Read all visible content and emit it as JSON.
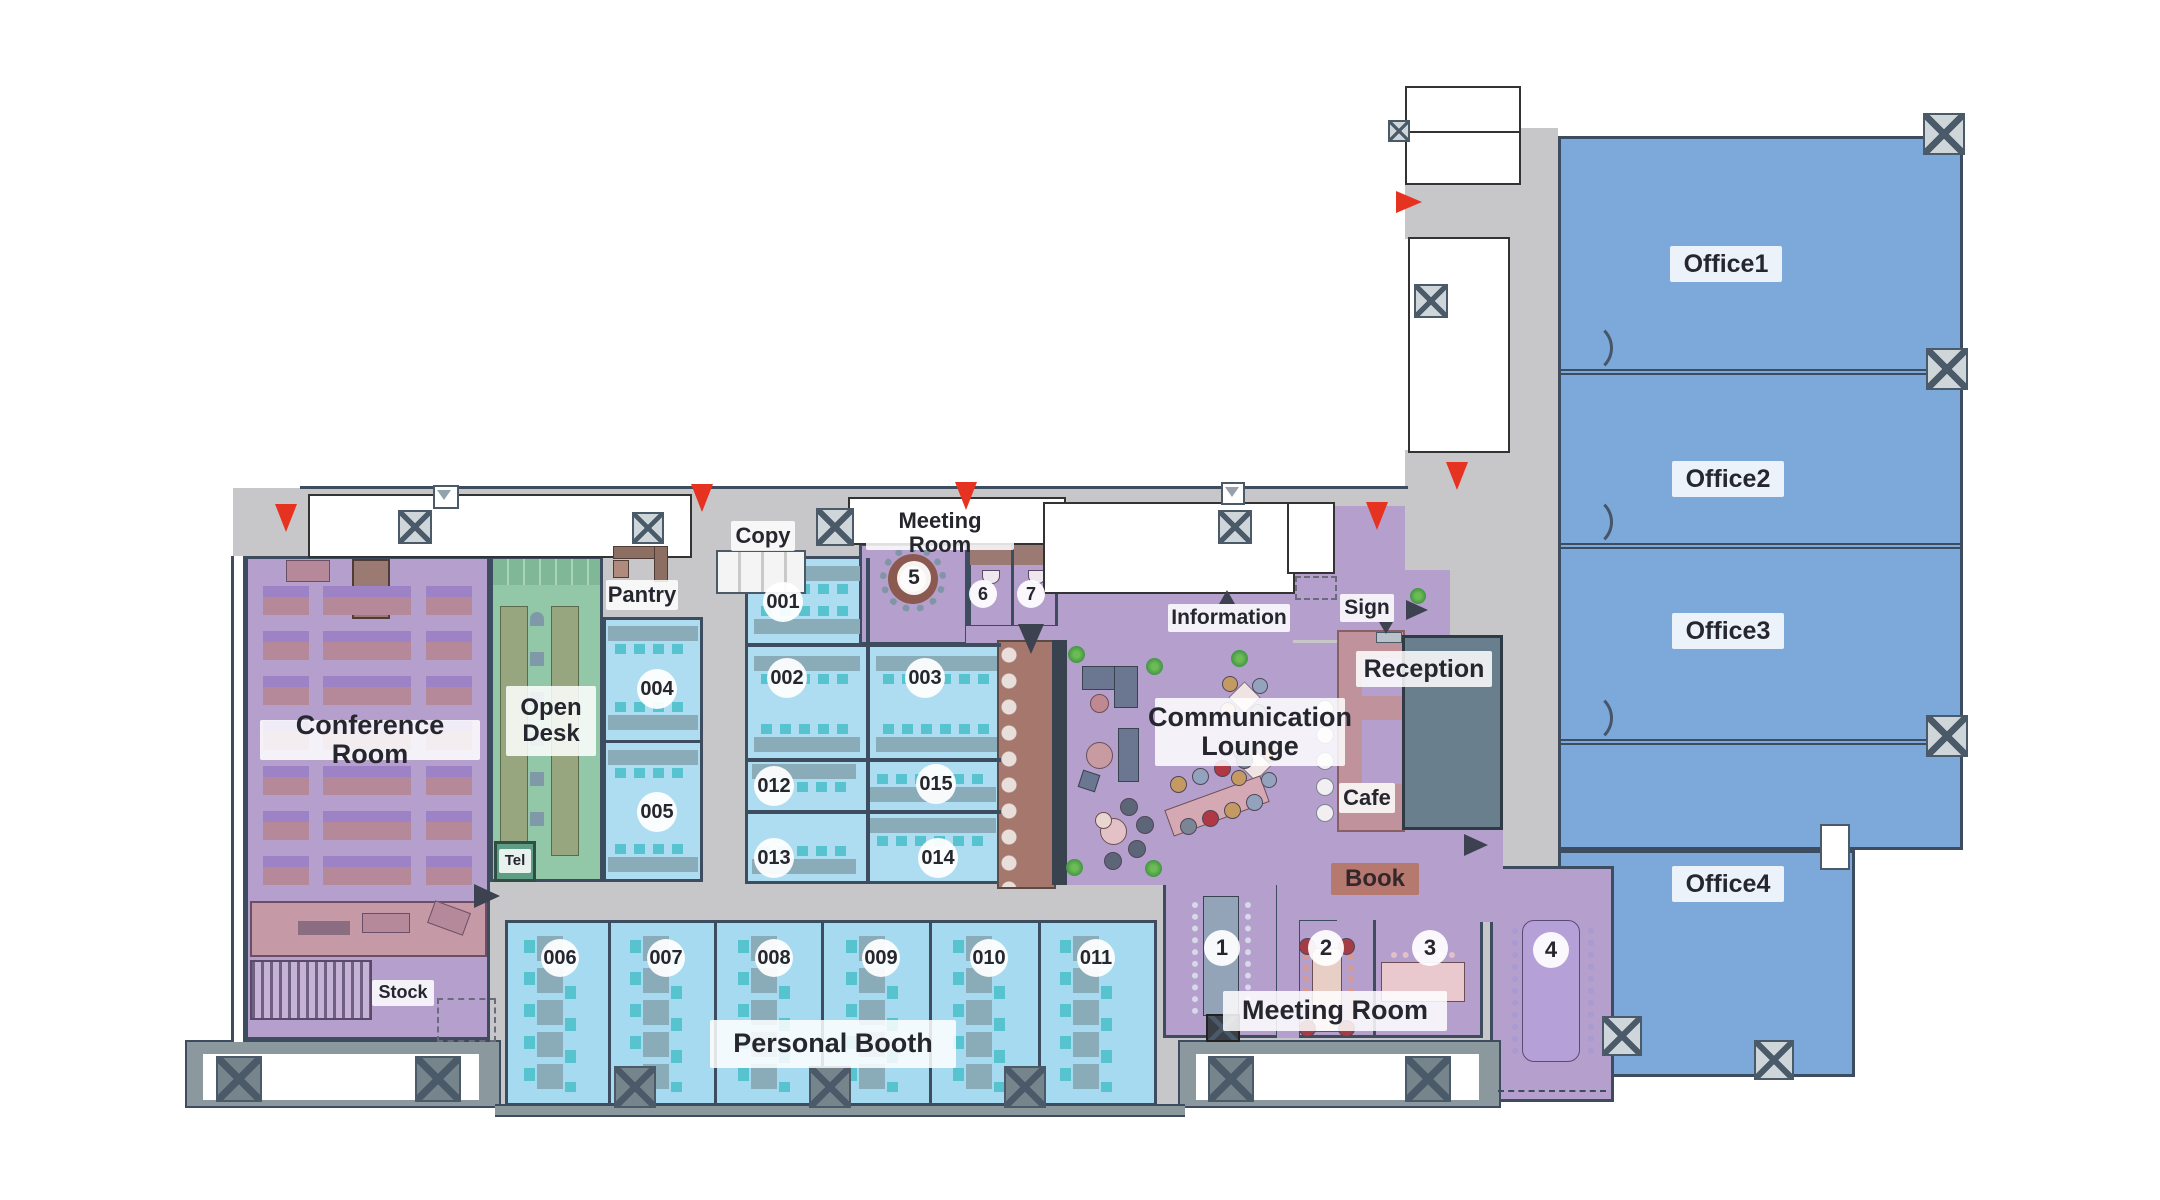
{
  "title": "Office floor plan",
  "labels": {
    "conference": "Conference Room",
    "open_desk": "Open Desk",
    "tel": "Tel",
    "pantry": "Pantry",
    "copy": "Copy",
    "meeting_room_top": "Meeting Room",
    "meeting_room_bottom": "Meeting Room",
    "personal_booth": "Personal Booth",
    "lounge": "Communication Lounge",
    "information": "Information",
    "sign": "Sign",
    "reception": "Reception",
    "cafe": "Cafe",
    "book": "Book",
    "stock": "Stock"
  },
  "offices": [
    "Office1",
    "Office2",
    "Office3",
    "Office4"
  ],
  "numbers": {
    "n001": "001",
    "n002": "002",
    "n003": "003",
    "n004": "004",
    "n005": "005",
    "n006": "006",
    "n007": "007",
    "n008": "008",
    "n009": "009",
    "n010": "010",
    "n011": "011",
    "n012": "012",
    "n013": "013",
    "n014": "014",
    "n015": "015",
    "m1": "1",
    "m2": "2",
    "m3": "3",
    "m4": "4",
    "m5": "5",
    "m6": "6",
    "m7": "7"
  },
  "colors": {
    "wall": "#3e4c60",
    "corridor": "#c7c6c8",
    "purple_room": "#b5a0cd",
    "cell_blue": "#aedcf1",
    "booth_blue": "#a5daf0",
    "office_blue": "#7ca9da",
    "open_desk_green": "#92c8a7",
    "tel_green": "#5f9e85",
    "rose": "#c0939c",
    "book_brown": "#a5776d",
    "reception_slate": "#697f8d",
    "chair_teal": "#56c3cf",
    "entrance_red": "#e63321",
    "window_bay": "#8b989e"
  }
}
